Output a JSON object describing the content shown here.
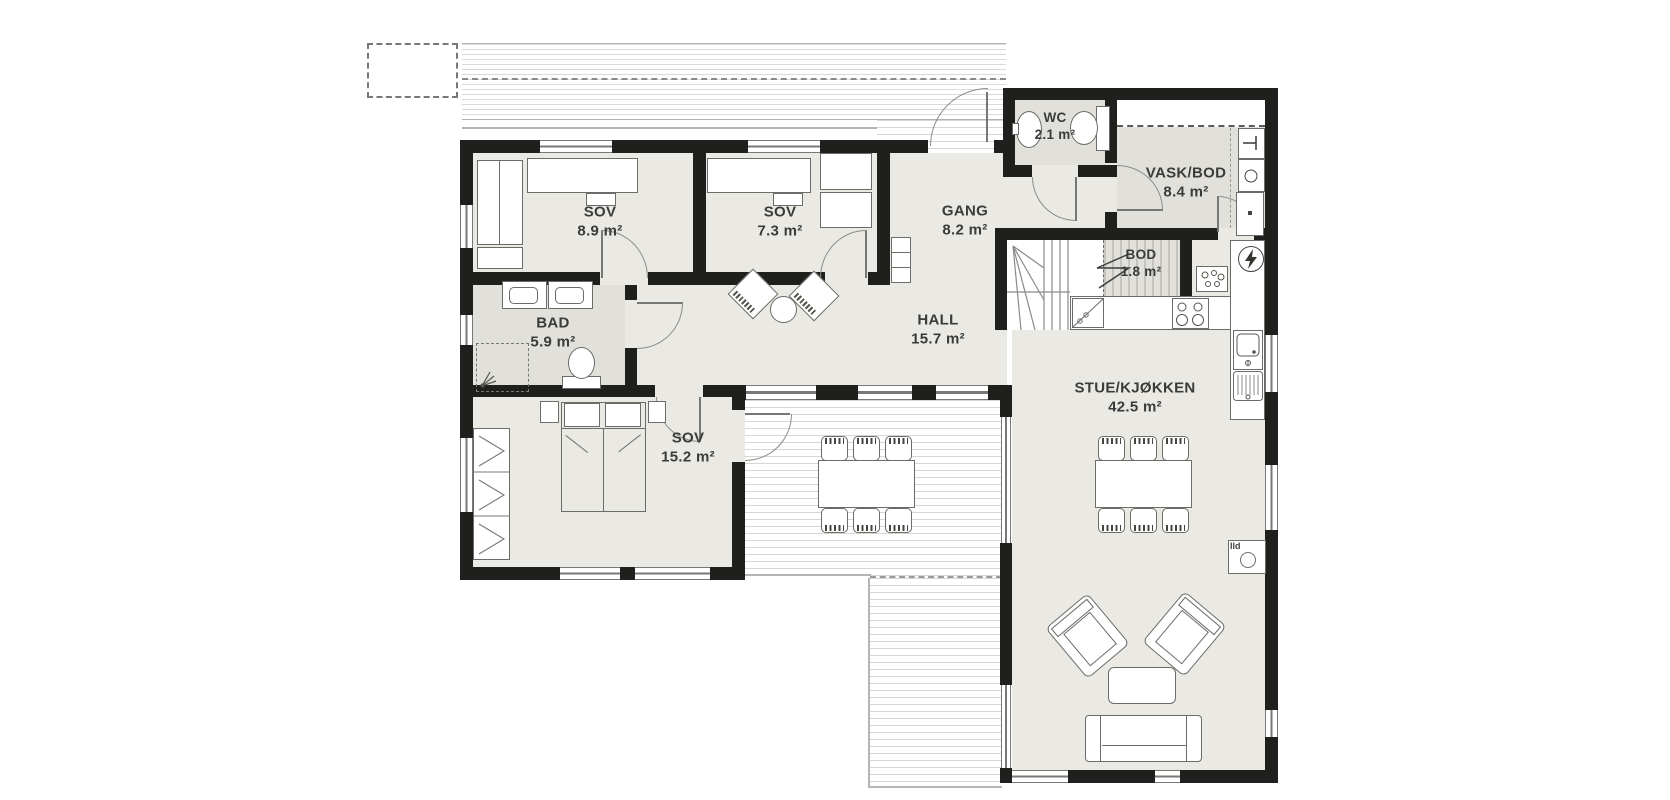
{
  "rooms": [
    {
      "name": "SOV",
      "area": "8.9 m²"
    },
    {
      "name": "SOV",
      "area": "7.3 m²"
    },
    {
      "name": "GANG",
      "area": "8.2 m²"
    },
    {
      "name": "WC",
      "area": "2.1 m²"
    },
    {
      "name": "VASK/BOD",
      "area": "8.4 m²"
    },
    {
      "name": "BOD",
      "area": "1.8 m²"
    },
    {
      "name": "HALL",
      "area": "15.7 m²"
    },
    {
      "name": "BAD",
      "area": "5.9 m²"
    },
    {
      "name": "SOV",
      "area": "15.2 m²"
    },
    {
      "name": "STUE/KJØKKEN",
      "area": "42.5 m²"
    }
  ],
  "annotations": {
    "fireplace": "Ild"
  },
  "icons": [
    "toilet-icon",
    "sink-icon",
    "shower-icon",
    "washer-icon",
    "water-heater-icon",
    "electrical-panel-icon",
    "faucet-icon",
    "stove-icon",
    "dishwasher-icon",
    "kitchen-sink-icon",
    "fireplace-icon"
  ],
  "colors": {
    "wall": "#1f1f1d",
    "floor": "#eae9e4",
    "wet_floor": "#e1e0db",
    "deck_line": "#d6d6d3",
    "outline": "#6b6b68",
    "text": "#3b3b3b"
  }
}
